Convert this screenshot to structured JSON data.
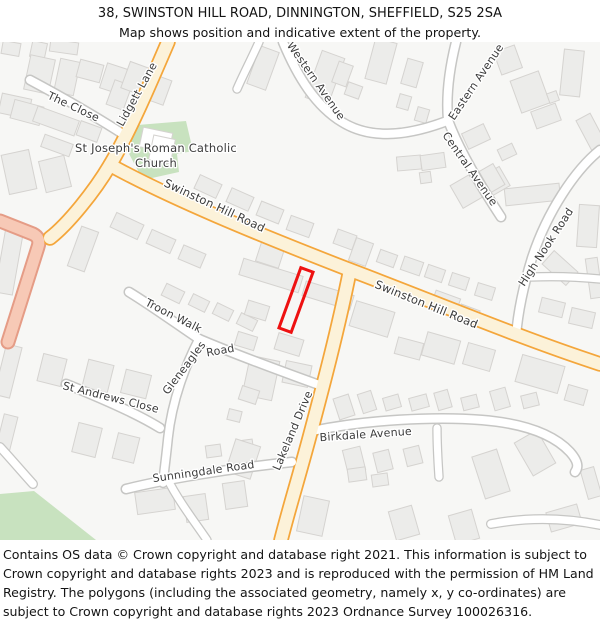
{
  "header": {
    "title": "38, SWINSTON HILL ROAD, DINNINGTON, SHEFFIELD, S25 2SA",
    "subtitle": "Map shows position and indicative extent of the property."
  },
  "footer": {
    "text": "Contains OS data © Crown copyright and database right 2021. This information is subject to Crown copyright and database rights 2023 and is reproduced with the permission of HM Land Registry. The polygons (including the associated geometry, namely x, y co-ordinates) are subject to Crown copyright and database rights 2023 Ordnance Survey 100026316."
  },
  "map": {
    "palette": {
      "background": "#f7f7f5",
      "building_fill": "#ececea",
      "building_stroke": "#d5d3d0",
      "church_fill": "#ffffff",
      "green": "#c8e2bf",
      "minor_casing": "#c6c6c4",
      "minor_fill": "#ffffff",
      "primary_casing": "#f4a63b",
      "primary_fill": "#fcf2d9",
      "pink_casing": "#e59c86",
      "pink_fill": "#f7c9b6",
      "label_color": "#3c3c3c",
      "label_halo": "#ffffff",
      "property_outline": "#ee1111"
    },
    "widths": {
      "minor": [
        11,
        8
      ],
      "primary": [
        15.5,
        12
      ],
      "pink": [
        15,
        11
      ]
    },
    "roads": [
      {
        "id": "the-close",
        "name": "The Close",
        "class": "minor",
        "d": "M 30,80 C 60,96 95,116 126,136"
      },
      {
        "id": "western-avenue",
        "name": "Western Avenue",
        "class": "minor",
        "d": "M 283,42 C 298,78 316,106 342,122 C 368,138 402,138 447,121"
      },
      {
        "id": "western-stub",
        "name": "",
        "class": "minor",
        "w": [
          9.5,
          7
        ],
        "d": "M 259,42 C 251,60 243,75 237,89"
      },
      {
        "id": "eastern-avenue",
        "name": "Eastern Avenue",
        "class": "minor",
        "d": "M 456,42 C 449,70 446,96 448,120"
      },
      {
        "id": "central-avenue",
        "name": "Central Avenue",
        "class": "minor",
        "d": "M 448,120 C 458,148 478,182 501,217"
      },
      {
        "id": "high-nook-road",
        "name": "High Nook Road",
        "class": "minor",
        "d": "M 600,150 C 575,170 547,212 532,258 C 524,284 518,312 516,336"
      },
      {
        "id": "high-nook-branch",
        "name": "",
        "class": "minor",
        "w": [
          9.5,
          7
        ],
        "d": "M 531,277 C 555,276 580,277 600,279"
      },
      {
        "id": "troon-walk",
        "name": "Troon Walk",
        "class": "minor",
        "d": "M 129,292 C 152,306 178,325 199,339"
      },
      {
        "id": "gleneagles-road",
        "name": "Gleneagles Road",
        "class": "minor",
        "d": "M 199,339 C 232,353 272,368 322,386"
      },
      {
        "id": "gleneagles-road-south",
        "name": "",
        "class": "minor",
        "w": [
          10.5,
          7.5
        ],
        "d": "M 199,339 C 186,364 172,400 168,438 C 166,458 164,472 163,483"
      },
      {
        "id": "st-andrews-close",
        "name": "St Andrews Close",
        "class": "minor",
        "d": "M 66,384 C 96,396 136,413 160,428"
      },
      {
        "id": "sunningdale-road",
        "name": "Sunningdale Road",
        "class": "minor",
        "d": "M 126,489 C 162,480 225,469 292,462"
      },
      {
        "id": "sunningdale-south",
        "name": "",
        "class": "minor",
        "w": [
          9.5,
          7
        ],
        "d": "M 168,480 C 178,500 194,521 207,540"
      },
      {
        "id": "birkdale-avenue",
        "name": "Birkdale Avenue",
        "class": "minor",
        "d": "M 312,431 C 365,420 435,416 482,420 C 530,424 556,437 570,452 C 578,461 579,467 575,472"
      },
      {
        "id": "birkdale-stub",
        "name": "",
        "class": "minor",
        "w": [
          9.5,
          7
        ],
        "d": "M 437,428 C 437,445 438,462 439,477"
      },
      {
        "id": "sw-cul-de-sac",
        "name": "",
        "class": "minor",
        "w": [
          10,
          7.5
        ],
        "d": "M 0,447 C 12,460 23,473 33,484"
      },
      {
        "id": "se-road",
        "name": "",
        "class": "minor",
        "w": [
          10,
          7.5
        ],
        "d": "M 491,524 C 528,517 566,518 600,525"
      },
      {
        "id": "unnamed-road-west",
        "name": "",
        "class": "pink",
        "d": "M 0,221 L 33,234 Q 41,238 38,247 L 8,342"
      },
      {
        "id": "lidgett-lane",
        "name": "Lidgett Lane",
        "class": "primary",
        "d": "M 168,42 C 150,84 129,133 110,165 C 94,192 68,224 50,238"
      },
      {
        "id": "swinston-hill-road",
        "name": "Swinston Hill Road",
        "class": "primary",
        "d": "M 110,165 C 170,198 255,233 345,268 C 430,300 520,338 600,364"
      },
      {
        "id": "lakeland-drive",
        "name": "Lakeland Drive",
        "class": "primary",
        "d": "M 350,270 C 338,330 322,390 310,435 C 298,480 288,512 281,540"
      }
    ],
    "labels": [
      {
        "text": "The Close",
        "x": 72,
        "y": 110,
        "r": 25,
        "s": 11
      },
      {
        "text": "Lidgett Lane",
        "x": 140,
        "y": 96,
        "r": -61,
        "s": 11
      },
      {
        "text": "St Joseph's Roman Catholic",
        "x": 156,
        "y": 152,
        "r": 0,
        "s": 11.5
      },
      {
        "text": "Church",
        "x": 156,
        "y": 167,
        "r": 0,
        "s": 11.5
      },
      {
        "text": "Western Avenue",
        "x": 313,
        "y": 83,
        "r": 55,
        "s": 11
      },
      {
        "text": "Eastern Avenue",
        "x": 479,
        "y": 84,
        "r": -56,
        "s": 11
      },
      {
        "text": "Central Avenue",
        "x": 467,
        "y": 171,
        "r": 55,
        "s": 11
      },
      {
        "text": "High Nook Road",
        "x": 549,
        "y": 249,
        "r": -57,
        "s": 11
      },
      {
        "text": "Swinston Hill Road",
        "x": 213,
        "y": 209,
        "r": 25,
        "s": 11.5
      },
      {
        "text": "Swinston Hill Road",
        "x": 425,
        "y": 308,
        "r": 22,
        "s": 11.5
      },
      {
        "text": "Troon Walk",
        "x": 172,
        "y": 319,
        "r": 27,
        "s": 11
      },
      {
        "text": "Gleneagles",
        "x": 187,
        "y": 370,
        "r": -53,
        "s": 11
      },
      {
        "text": "Road",
        "x": 221,
        "y": 354,
        "r": -10,
        "s": 11
      },
      {
        "text": "St Andrews Close",
        "x": 110,
        "y": 401,
        "r": 14,
        "s": 11
      },
      {
        "text": "Lakeland Drive",
        "x": 296,
        "y": 432,
        "r": -67,
        "s": 11
      },
      {
        "text": "Birkdale Avenue",
        "x": 366,
        "y": 438,
        "r": -4,
        "s": 11
      },
      {
        "text": "Sunningdale Road",
        "x": 204,
        "y": 475,
        "r": -8,
        "s": 11
      }
    ],
    "areas": [
      {
        "id": "church-grounds-green",
        "points": "126,126 186,121 193,151 177,154 179,172 143,180 127,150"
      },
      {
        "id": "green-space-southwest",
        "points": "0,494 34,491 96,540 0,540"
      }
    ],
    "church_buildings": [
      [
        141,
        130,
        30,
        20,
        12
      ],
      [
        151,
        137,
        22,
        25,
        12
      ]
    ],
    "buildings": [
      [
        2,
        42,
        18,
        13,
        10
      ],
      [
        50,
        41,
        28,
        12,
        8
      ],
      [
        31,
        42,
        15,
        16,
        12
      ],
      [
        27,
        57,
        25,
        35,
        12
      ],
      [
        57,
        60,
        20,
        34,
        12
      ],
      [
        78,
        62,
        24,
        18,
        15
      ],
      [
        103,
        66,
        24,
        26,
        18
      ],
      [
        110,
        82,
        18,
        26,
        20
      ],
      [
        0,
        96,
        30,
        20,
        12
      ],
      [
        12,
        103,
        30,
        19,
        15
      ],
      [
        34,
        113,
        44,
        16,
        20
      ],
      [
        42,
        139,
        30,
        13,
        20
      ],
      [
        78,
        124,
        22,
        15,
        20
      ],
      [
        125,
        64,
        20,
        28,
        20
      ],
      [
        150,
        77,
        18,
        26,
        20
      ],
      [
        5,
        152,
        28,
        40,
        -12
      ],
      [
        42,
        158,
        26,
        32,
        -14
      ],
      [
        0,
        230,
        18,
        64,
        10
      ],
      [
        74,
        228,
        18,
        42,
        20
      ],
      [
        196,
        179,
        24,
        15,
        25
      ],
      [
        228,
        192,
        24,
        15,
        24
      ],
      [
        258,
        205,
        24,
        15,
        22
      ],
      [
        288,
        219,
        24,
        15,
        20
      ],
      [
        112,
        218,
        30,
        16,
        25
      ],
      [
        148,
        234,
        26,
        15,
        24
      ],
      [
        180,
        249,
        24,
        15,
        23
      ],
      [
        163,
        287,
        20,
        13,
        26
      ],
      [
        190,
        297,
        18,
        12,
        26
      ],
      [
        214,
        306,
        18,
        12,
        26
      ],
      [
        238,
        316,
        18,
        12,
        26
      ],
      [
        240,
        267,
        62,
        17,
        17
      ],
      [
        303,
        288,
        50,
        15,
        17
      ],
      [
        246,
        303,
        22,
        15,
        17
      ],
      [
        236,
        334,
        20,
        14,
        17
      ],
      [
        276,
        336,
        26,
        17,
        17
      ],
      [
        258,
        245,
        24,
        20,
        18
      ],
      [
        335,
        232,
        20,
        15,
        20
      ],
      [
        352,
        240,
        18,
        24,
        20
      ],
      [
        378,
        252,
        18,
        13,
        20
      ],
      [
        402,
        259,
        20,
        14,
        19
      ],
      [
        426,
        267,
        18,
        13,
        19
      ],
      [
        450,
        275,
        18,
        13,
        18
      ],
      [
        476,
        285,
        18,
        13,
        17
      ],
      [
        540,
        300,
        24,
        15,
        14
      ],
      [
        570,
        310,
        24,
        16,
        13
      ],
      [
        352,
        306,
        40,
        26,
        17
      ],
      [
        432,
        294,
        26,
        20,
        20
      ],
      [
        458,
        307,
        20,
        16,
        20
      ],
      [
        424,
        336,
        34,
        24,
        16
      ],
      [
        465,
        346,
        28,
        22,
        16
      ],
      [
        518,
        360,
        44,
        28,
        16
      ],
      [
        566,
        387,
        20,
        16,
        16
      ],
      [
        396,
        340,
        26,
        17,
        15
      ],
      [
        246,
        358,
        30,
        40,
        12
      ],
      [
        284,
        363,
        26,
        22,
        12
      ],
      [
        228,
        410,
        13,
        11,
        14
      ],
      [
        40,
        356,
        24,
        28,
        14
      ],
      [
        85,
        362,
        26,
        28,
        14
      ],
      [
        123,
        372,
        26,
        24,
        14
      ],
      [
        75,
        425,
        24,
        30,
        14
      ],
      [
        115,
        435,
        22,
        26,
        14
      ],
      [
        0,
        345,
        16,
        52,
        14
      ],
      [
        0,
        415,
        14,
        34,
        14
      ],
      [
        136,
        490,
        38,
        22,
        -8
      ],
      [
        185,
        495,
        22,
        26,
        -8
      ],
      [
        224,
        482,
        22,
        26,
        -8
      ],
      [
        206,
        445,
        15,
        12,
        -8
      ],
      [
        238,
        440,
        15,
        12,
        -8
      ],
      [
        230,
        442,
        26,
        34,
        18
      ],
      [
        240,
        388,
        18,
        14,
        18
      ],
      [
        336,
        396,
        16,
        22,
        -18
      ],
      [
        360,
        392,
        14,
        20,
        -18
      ],
      [
        384,
        396,
        16,
        13,
        -16
      ],
      [
        410,
        396,
        18,
        13,
        -15
      ],
      [
        436,
        391,
        14,
        18,
        -16
      ],
      [
        462,
        396,
        16,
        13,
        -14
      ],
      [
        492,
        389,
        16,
        20,
        -16
      ],
      [
        522,
        394,
        16,
        13,
        -14
      ],
      [
        345,
        448,
        18,
        24,
        -14
      ],
      [
        375,
        451,
        16,
        20,
        -14
      ],
      [
        405,
        447,
        16,
        18,
        -14
      ],
      [
        478,
        452,
        26,
        44,
        -18
      ],
      [
        522,
        434,
        26,
        38,
        -30
      ],
      [
        452,
        512,
        24,
        30,
        -16
      ],
      [
        548,
        508,
        32,
        20,
        -16
      ],
      [
        584,
        468,
        14,
        30,
        -16
      ],
      [
        300,
        498,
        26,
        36,
        12
      ],
      [
        348,
        468,
        18,
        13,
        -8
      ],
      [
        372,
        474,
        16,
        12,
        -8
      ],
      [
        392,
        508,
        24,
        30,
        -16
      ],
      [
        253,
        48,
        20,
        40,
        20
      ],
      [
        313,
        53,
        24,
        50,
        20
      ],
      [
        335,
        63,
        15,
        22,
        20
      ],
      [
        346,
        84,
        15,
        13,
        20
      ],
      [
        370,
        40,
        22,
        42,
        15
      ],
      [
        404,
        60,
        16,
        26,
        16
      ],
      [
        398,
        95,
        12,
        14,
        16
      ],
      [
        416,
        108,
        12,
        14,
        16
      ],
      [
        397,
        156,
        24,
        14,
        -5
      ],
      [
        421,
        154,
        24,
        15,
        -8
      ],
      [
        420,
        172,
        11,
        11,
        -8
      ],
      [
        464,
        128,
        24,
        17,
        -25
      ],
      [
        486,
        170,
        20,
        22,
        -30
      ],
      [
        499,
        146,
        16,
        12,
        -25
      ],
      [
        497,
        48,
        22,
        24,
        -20
      ],
      [
        515,
        75,
        30,
        34,
        -20
      ],
      [
        533,
        107,
        26,
        18,
        -20
      ],
      [
        548,
        92,
        10,
        10,
        -20
      ],
      [
        562,
        50,
        20,
        46,
        6
      ],
      [
        583,
        115,
        16,
        34,
        -28
      ],
      [
        455,
        178,
        24,
        26,
        -30
      ],
      [
        484,
        166,
        16,
        24,
        -30
      ],
      [
        505,
        186,
        55,
        17,
        -6
      ],
      [
        578,
        205,
        20,
        42,
        4
      ],
      [
        551,
        252,
        18,
        32,
        -48
      ],
      [
        588,
        258,
        12,
        40,
        -8
      ]
    ],
    "property": {
      "cx": 296,
      "cy": 300,
      "w": 13,
      "h": 64,
      "r": 20
    }
  }
}
